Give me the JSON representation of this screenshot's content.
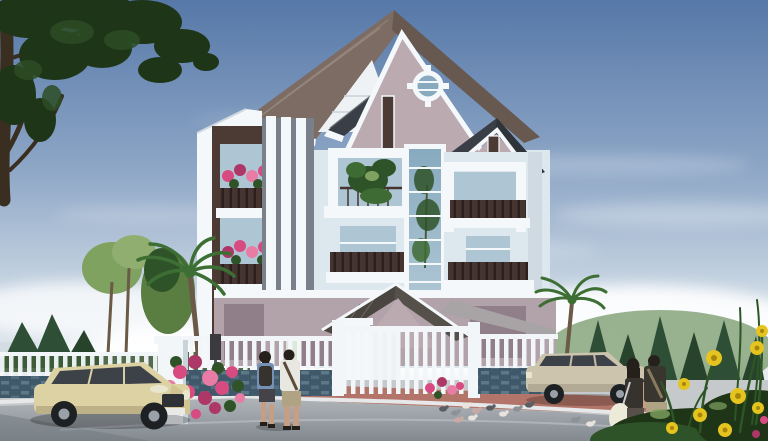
{
  "scene": {
    "type": "architectural-exterior-rendering",
    "subject": "modern multi-storey villa with mauve roof and white facade",
    "setting": "sunny day, clear blue sky with light clouds, tree-lined street",
    "objects": [
      {
        "name": "villa",
        "desc": "four-storey white villa, pink-mauve gable walls, dark tiled roofs, porthole gable ornament, balconies with dark slat planters and pink flowers"
      },
      {
        "name": "front-fence",
        "desc": "white vertical-bar fence and gate on blue-grey stone base"
      },
      {
        "name": "cream-suv",
        "desc": "cream coloured SUV parked on street, left"
      },
      {
        "name": "silver-suv",
        "desc": "beige-silver SUV parked at right curb"
      },
      {
        "name": "couple-crossing",
        "desc": "two pedestrians crossing street toward gate"
      },
      {
        "name": "couple-right",
        "desc": "couple walking away on right sidewalk, woman with white bag"
      },
      {
        "name": "pigeons",
        "desc": "small flock of pigeons on roadway"
      },
      {
        "name": "palms",
        "desc": "palm trees in yard left of gate and right of house"
      },
      {
        "name": "foreground-tree",
        "desc": "dark overhanging tree canopy, top-left corner"
      },
      {
        "name": "flowers",
        "desc": "pink bougainvillea at fence, yellow wildflowers bottom-right"
      }
    ]
  },
  "palette": {
    "sky_top": "#5678a8",
    "sky_mid": "#8da6c6",
    "sky_low": "#c9d6e3",
    "sky_horizon": "#edf1f4",
    "cloud": "#ffffff",
    "roof_main": "#7d6c63",
    "roof_main_dark": "#685950",
    "roof_dark": "#3a3f47",
    "roof_porch": "#4a4540",
    "gable_wall": "#bcaab1",
    "wall_white": "#f4f8fa",
    "wall_white_shade": "#dde7ee",
    "wall_slat": "#eef2f5",
    "accent_dark": "#4c3a35",
    "rail_dark": "#453430",
    "glass": "#aec6d4",
    "glass_deep": "#87aabf",
    "ground_wall": "#b2a2a9",
    "ground_wall_dark": "#907f88",
    "fence_white": "#f2f6f8",
    "stone_base": "#3f586a",
    "stone_light": "#647f8e",
    "sidewalk": "#c5c9cc",
    "paving_red": "#b3756a",
    "curb": "#e6e8e9",
    "road_light": "#b0b5b9",
    "road_dark": "#82898f",
    "foliage_dark": "#1f3518",
    "foliage_mid": "#2f5328",
    "foliage_light": "#7fa261",
    "palm_green": "#3d6e33",
    "conifer": "#2e4f36",
    "hedge": "#3f5c3a",
    "blue_wall": "#5a7b9e",
    "trunk": "#6b5a46",
    "branch": "#3a2e20",
    "flower_pink": "#d84b80",
    "flower_pink_dark": "#ad3766",
    "flower_yellow": "#e5c41f",
    "flower_center": "#a8860e",
    "car_cream": "#dcd2a3",
    "car_cream_shade": "#b5aa80",
    "car_silver": "#ccc4ad",
    "window_tint": "#3d4248",
    "skin": "#c59e83",
    "hair_dark": "#26201c",
    "shirt_white": "#e9e7e1",
    "top_blue": "#7591b5",
    "dark_cloth": "#36322e",
    "khaki": "#b0a383",
    "bag_white": "#ecead8"
  }
}
